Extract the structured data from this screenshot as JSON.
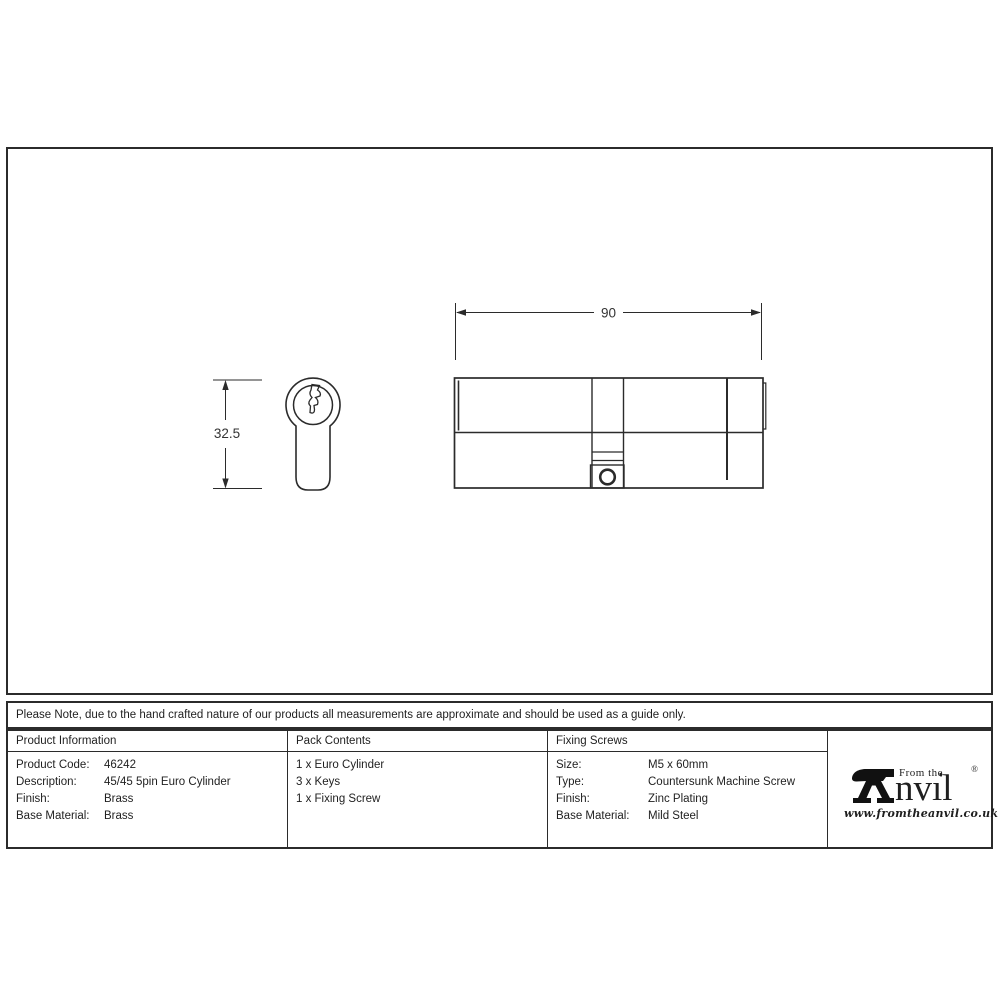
{
  "sheet": {
    "background": "#ffffff",
    "line_color": "#2b2b2b"
  },
  "drawing": {
    "side_view_width_label": "90",
    "front_view_height_label": "32.5"
  },
  "note": {
    "text": "Please Note, due to the hand crafted nature of our products all measurements are approximate and should be used as a guide only."
  },
  "table": {
    "product_information": {
      "header": "Product Information",
      "rows": [
        {
          "label": "Product Code:",
          "value": "46242"
        },
        {
          "label": "Description:",
          "value": "45/45 5pin Euro Cylinder"
        },
        {
          "label": "Finish:",
          "value": "Brass"
        },
        {
          "label": "Base Material:",
          "value": "Brass"
        }
      ]
    },
    "pack_contents": {
      "header": "Pack Contents",
      "items": [
        "1 x Euro Cylinder",
        "3 x Keys",
        "1 x Fixing Screw"
      ]
    },
    "fixing_screws": {
      "header": "Fixing Screws",
      "rows": [
        {
          "label": "Size:",
          "value": "M5 x 60mm"
        },
        {
          "label": "Type:",
          "value": "Countersunk Machine Screw"
        },
        {
          "label": "Finish:",
          "value": "Zinc Plating"
        },
        {
          "label": "Base Material:",
          "value": "Mild Steel"
        }
      ]
    }
  },
  "logo": {
    "tagline": "From the",
    "brand_display": "nvıl",
    "i_dot": "♦",
    "registered_mark": "®",
    "website": "www.fromtheanvil.co.uk"
  }
}
